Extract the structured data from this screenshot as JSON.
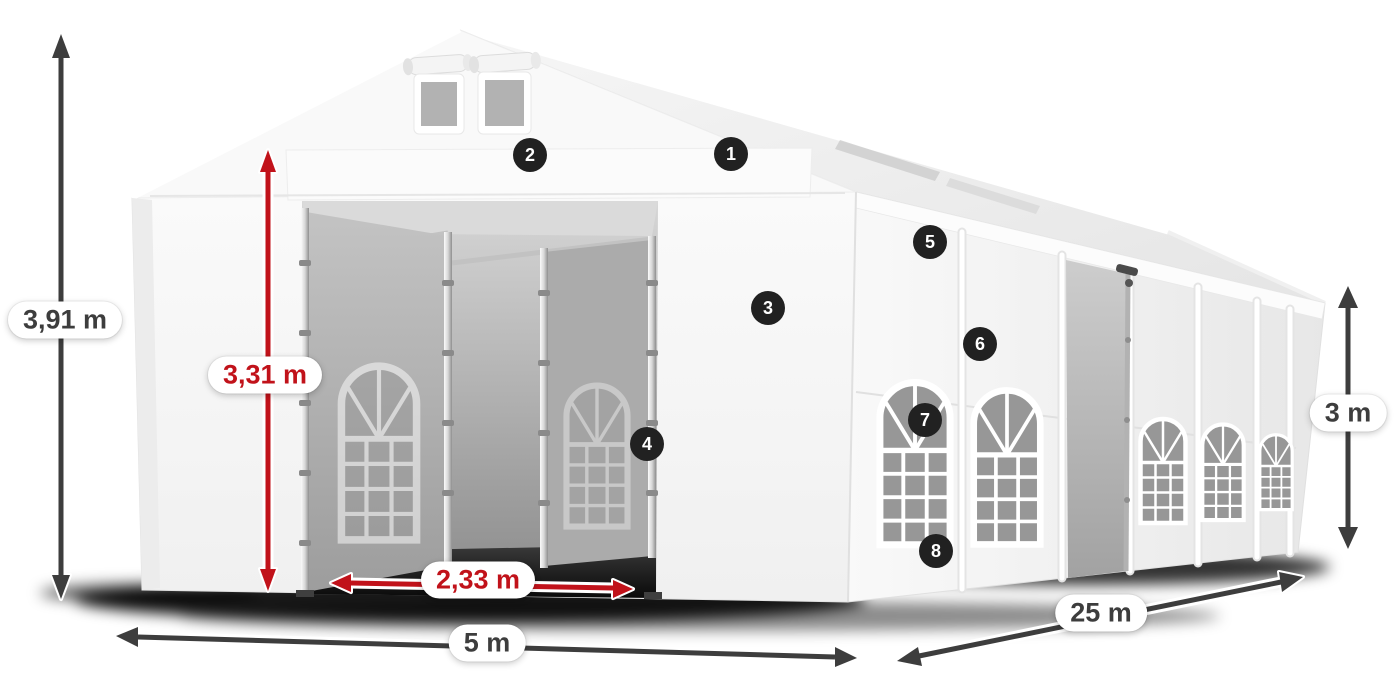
{
  "figure": {
    "subject": "white marquee tent with dimension annotations",
    "background": "#ffffff"
  },
  "colors": {
    "dimension_dark": "#3d3d3d",
    "dimension_red": "#c1121a",
    "badge_bg": "#212121",
    "badge_text": "#ffffff",
    "pill_bg": "#ffffff",
    "tent_white": "#f6f6f6",
    "curtain_gray": "#ababab",
    "shadow_black": "#0a0a0a"
  },
  "dimensions": [
    {
      "id": "total-height",
      "label": "3,91 m",
      "style": "dark"
    },
    {
      "id": "entrance-height",
      "label": "3,31 m",
      "style": "red"
    },
    {
      "id": "entrance-width",
      "label": "2,33 m",
      "style": "red"
    },
    {
      "id": "gable-width",
      "label": "5 m",
      "style": "dark"
    },
    {
      "id": "length",
      "label": "25 m",
      "style": "dark"
    },
    {
      "id": "side-height",
      "label": "3 m",
      "style": "dark"
    }
  ],
  "callouts": [
    {
      "number": "1"
    },
    {
      "number": "2"
    },
    {
      "number": "3"
    },
    {
      "number": "4"
    },
    {
      "number": "5"
    },
    {
      "number": "6"
    },
    {
      "number": "7"
    },
    {
      "number": "8"
    }
  ]
}
